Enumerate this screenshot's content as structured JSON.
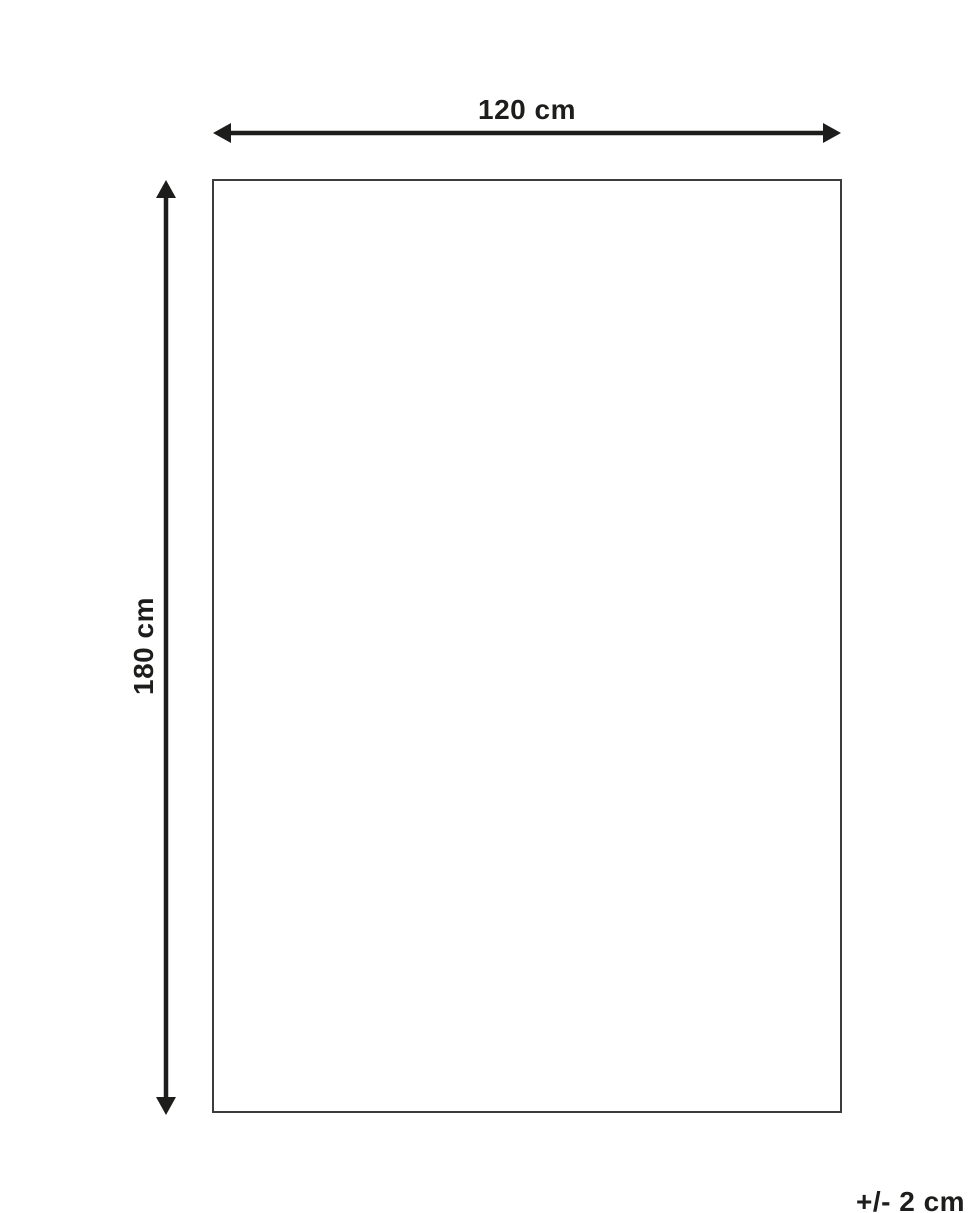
{
  "diagram": {
    "title": "product-dimension-diagram",
    "width_label": "120 cm",
    "height_label": "180 cm",
    "tolerance_label": "+/- 2 cm",
    "colors": {
      "arrow": "#1d1d1b",
      "outline": "#3c3c3b",
      "text": "#1d1d1b",
      "background": "#ffffff"
    }
  }
}
